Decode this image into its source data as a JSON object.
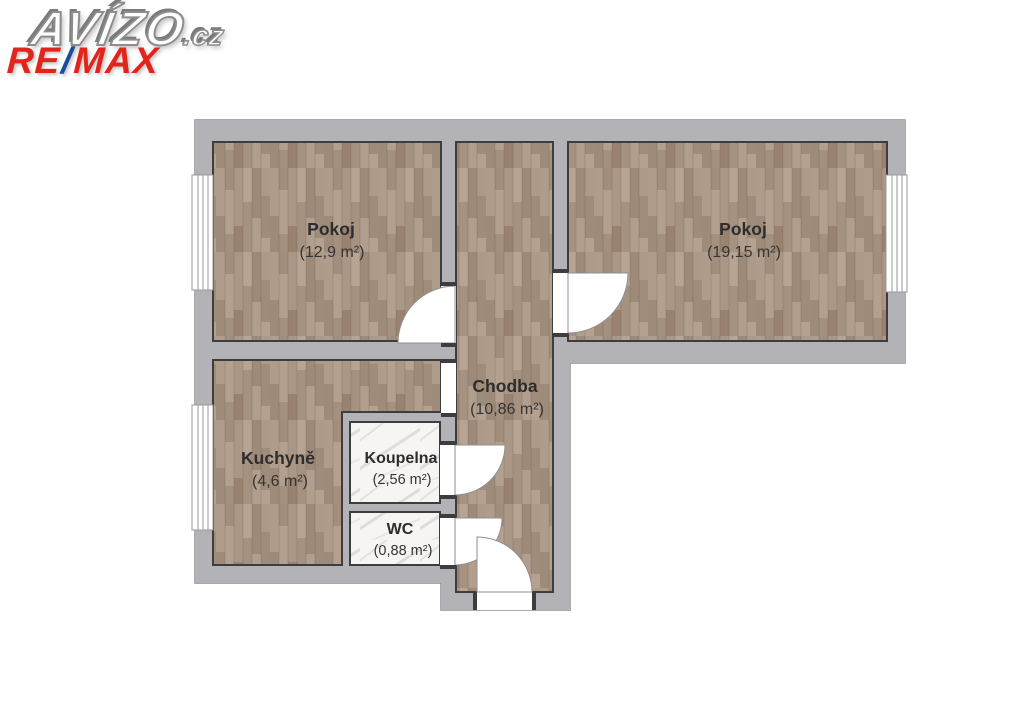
{
  "branding": {
    "avizo_text": "AVÍZO",
    "avizo_suffix": ".cz",
    "remax_re": "RE",
    "remax_slash": "/",
    "remax_max": "MAX",
    "remax_color": "#e1251b",
    "remax_slash_color": "#1c4b9e"
  },
  "floorplan": {
    "rooms": [
      {
        "id": "pokoj-left",
        "name": "Pokoj",
        "area": "(12,9 m²)",
        "floor": "wood"
      },
      {
        "id": "pokoj-right",
        "name": "Pokoj",
        "area": "(19,15 m²)",
        "floor": "wood"
      },
      {
        "id": "chodba",
        "name": "Chodba",
        "area": "(10,86 m²)",
        "floor": "wood"
      },
      {
        "id": "kuchyne",
        "name": "Kuchyně",
        "area": "(4,6 m²)",
        "floor": "wood"
      },
      {
        "id": "koupelna",
        "name": "Koupelna",
        "area": "(2,56 m²)",
        "floor": "tile"
      },
      {
        "id": "wc",
        "name": "WC",
        "area": "(0,88 m²)",
        "floor": "tile"
      }
    ],
    "colors": {
      "wall": "#b3b2b6",
      "floor_wood": "#aa9684",
      "floor_tile": "#f6f5f3",
      "room_outline": "#3d3d3d",
      "label_text": "#2d2d2d"
    }
  }
}
